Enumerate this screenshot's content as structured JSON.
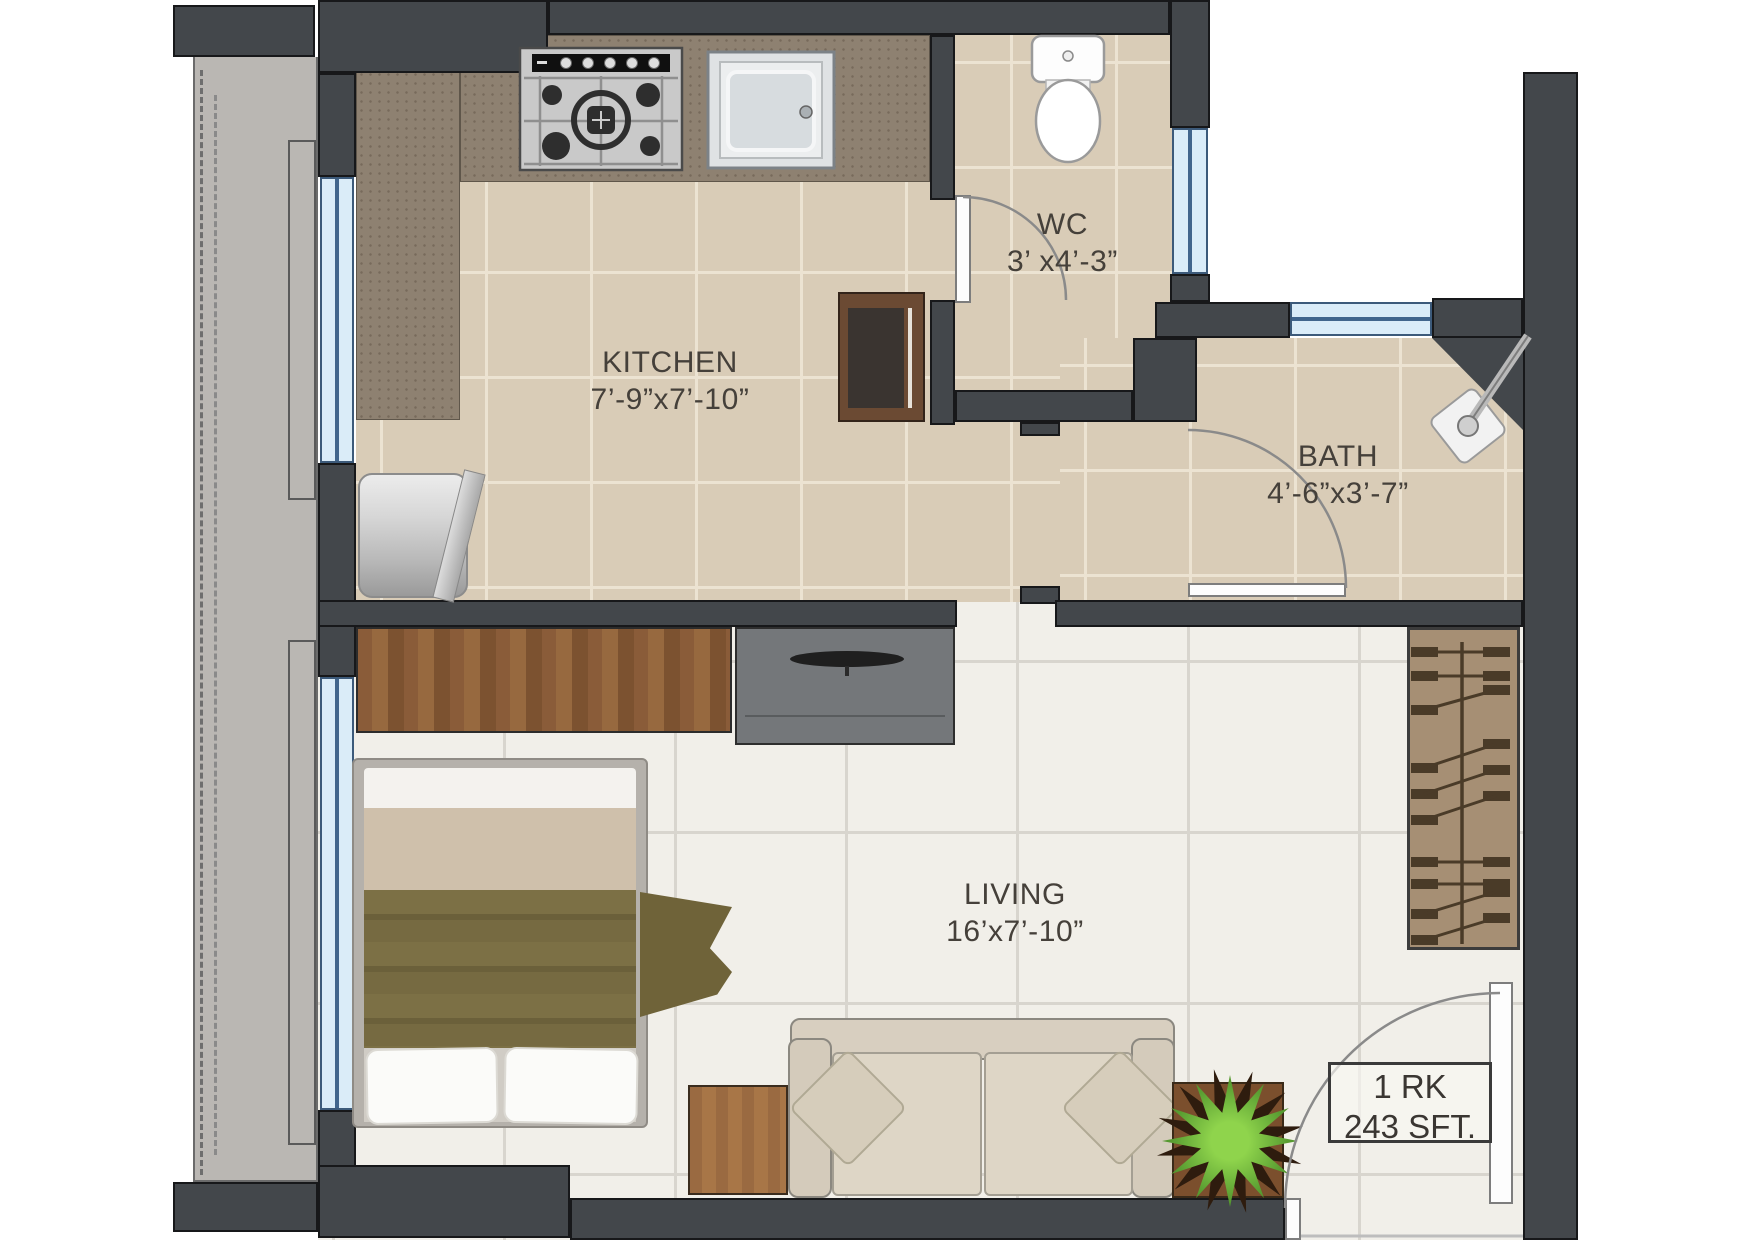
{
  "plan": {
    "rooms": {
      "kitchen": {
        "label": "KITCHEN",
        "dims": "7’-9”x7’-10”"
      },
      "wc": {
        "label": "WC",
        "dims": "3’ x4’-3”"
      },
      "bath": {
        "label": "BATH",
        "dims": "4’-6”x3’-7”"
      },
      "living": {
        "label": "LIVING",
        "dims": "16’x7’-10”"
      }
    },
    "unit_box": {
      "line1": "1 RK",
      "line2": "243 SFT."
    },
    "fixtures": [
      "gas-stove",
      "kitchen-sink",
      "refrigerator",
      "toilet",
      "shower",
      "washing-cylinder",
      "wardrobe",
      "tv-unit",
      "double-bed",
      "side-table",
      "sofa",
      "potted-plant",
      "hanger-rack"
    ],
    "colors": {
      "wall": "#43474b",
      "window_glass": "#daecf8",
      "window_frame": "#3c5a7a",
      "kitchen_tile": "#d9ccb7",
      "living_tile": "#f1efe9",
      "counter_granite": "#8e8171",
      "wood": "#8a5c39",
      "sofa_fabric": "#d9d0c0",
      "blanket_olive": "#776b40",
      "plant_green": "#5a9e32"
    }
  }
}
